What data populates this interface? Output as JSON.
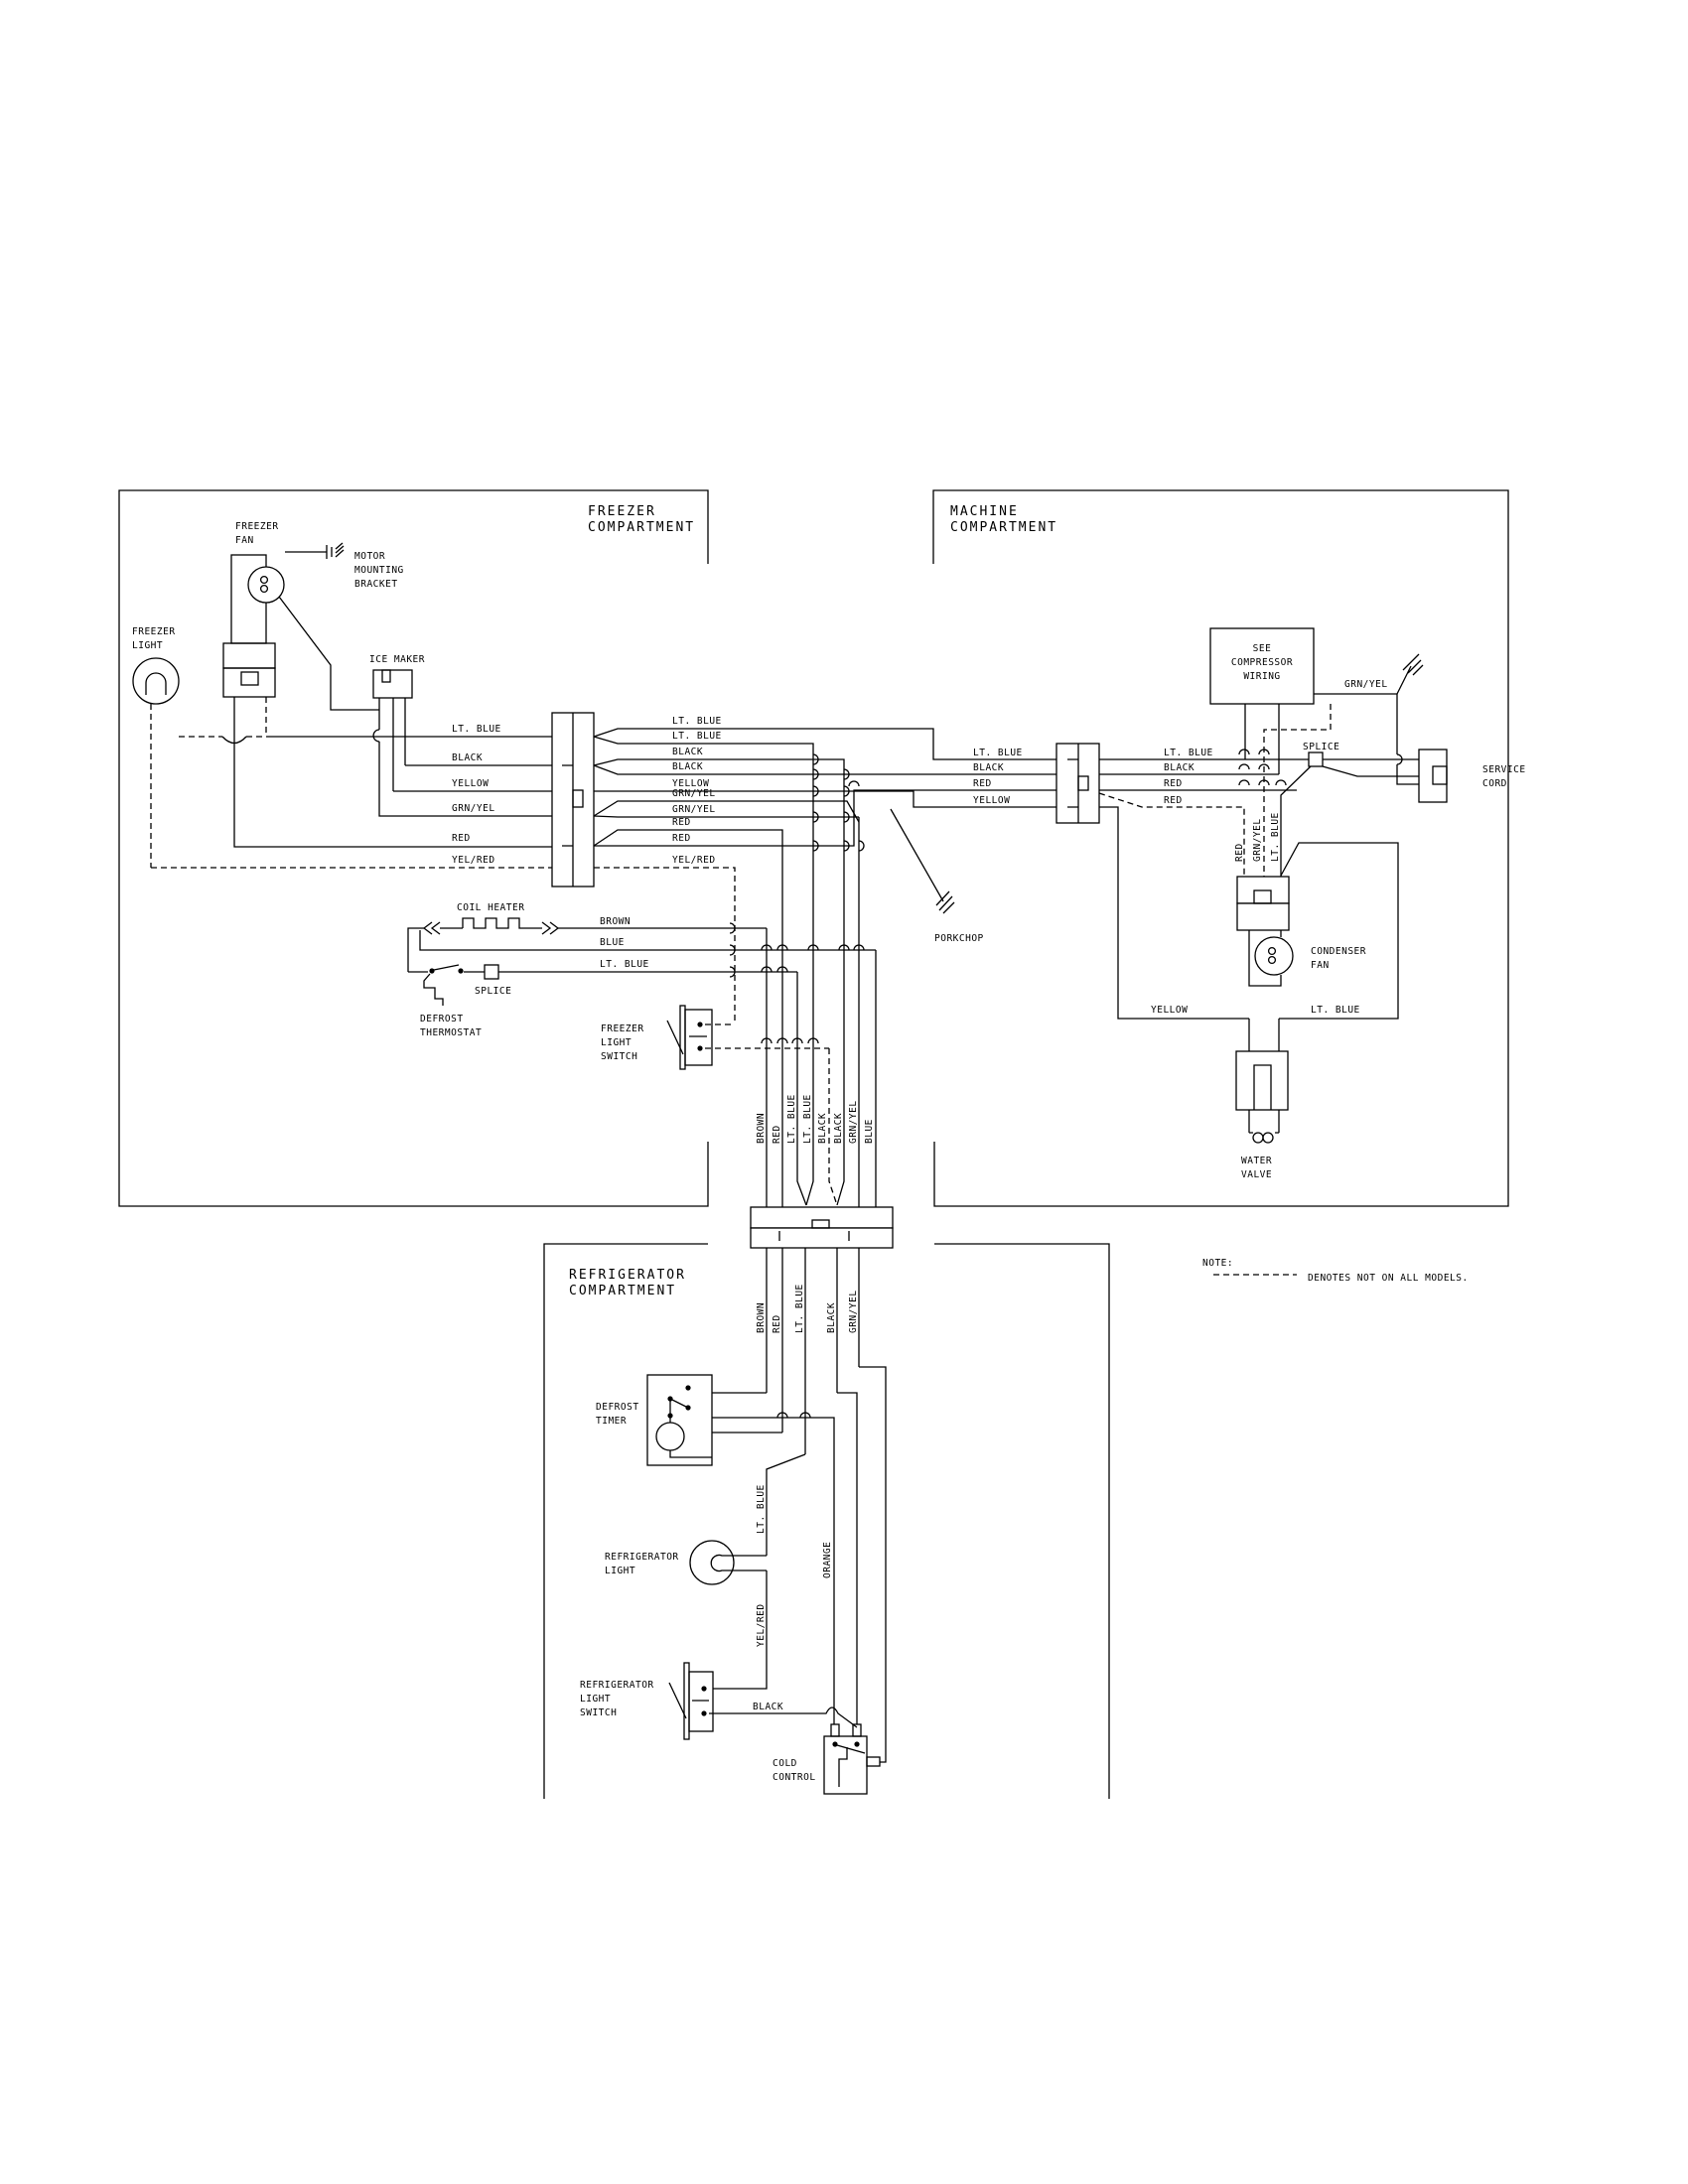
{
  "page": {
    "background": "#ffffff",
    "line_color": "#000000"
  },
  "sections": {
    "freezer": [
      "FREEZER",
      "COMPARTMENT"
    ],
    "machine": [
      "MACHINE",
      "COMPARTMENT"
    ],
    "refrigerator": [
      "REFRIGERATOR",
      "COMPARTMENT"
    ]
  },
  "components": {
    "freezer_fan": [
      "FREEZER",
      "FAN"
    ],
    "motor_mounting_bracket": [
      "MOTOR",
      "MOUNTING",
      "BRACKET"
    ],
    "freezer_light": [
      "FREEZER",
      "LIGHT"
    ],
    "ice_maker": [
      "ICE MAKER"
    ],
    "coil_heater": [
      "COIL HEATER"
    ],
    "splice_freezer": [
      "SPLICE"
    ],
    "defrost_thermostat": [
      "DEFROST",
      "THERMOSTAT"
    ],
    "freezer_light_switch": [
      "FREEZER",
      "LIGHT",
      "SWITCH"
    ],
    "porkchop": [
      "PORKCHOP"
    ],
    "compressor": [
      "SEE",
      "COMPRESSOR",
      "WIRING"
    ],
    "splice_machine": [
      "SPLICE"
    ],
    "service_cord": [
      "SERVICE",
      "CORD"
    ],
    "condenser_fan": [
      "CONDENSER",
      "FAN"
    ],
    "water_valve": [
      "WATER",
      "VALVE"
    ],
    "defrost_timer": [
      "DEFROST",
      "TIMER"
    ],
    "refrigerator_light": [
      "REFRIGERATOR",
      "LIGHT"
    ],
    "refrigerator_light_switch": [
      "REFRIGERATOR",
      "LIGHT",
      "SWITCH"
    ],
    "cold_control": [
      "COLD",
      "CONTROL"
    ]
  },
  "wires": {
    "freezer_connector_left": [
      "LT. BLUE",
      "BLACK",
      "YELLOW",
      "GRN/YEL",
      "RED",
      "YEL/RED"
    ],
    "freezer_connector_right": [
      "LT. BLUE",
      "LT. BLUE",
      "BLACK",
      "BLACK",
      "YELLOW",
      "GRN/YEL",
      "GRN/YEL",
      "RED",
      "RED",
      "YEL/RED"
    ],
    "coil_heater": [
      "BROWN",
      "BLUE",
      "LT. BLUE"
    ],
    "machine_connector_left": [
      "LT. BLUE",
      "BLACK",
      "RED",
      "YELLOW"
    ],
    "machine_connector_right": [
      "LT. BLUE",
      "BLACK",
      "RED",
      "RED"
    ],
    "machine_vertical": [
      "RED",
      "GRN/YEL",
      "LT. BLUE"
    ],
    "machine_bottom": [
      "YELLOW",
      "LT. BLUE"
    ],
    "compressor_ground": "GRN/YEL",
    "bundle_upper": [
      "BROWN",
      "RED",
      "LT. BLUE",
      "LT. BLUE",
      "BLACK",
      "BLACK",
      "GRN/YEL",
      "BLUE"
    ],
    "bundle_lower": [
      "BROWN",
      "RED",
      "LT. BLUE",
      "BLACK",
      "GRN/YEL"
    ],
    "refrig_lt_blue": "LT. BLUE",
    "refrig_orange": "ORANGE",
    "refrig_yel_red": "YEL/RED",
    "refrig_black": "BLACK"
  },
  "note": {
    "label": "NOTE:",
    "text": "DENOTES NOT ON ALL MODELS."
  }
}
